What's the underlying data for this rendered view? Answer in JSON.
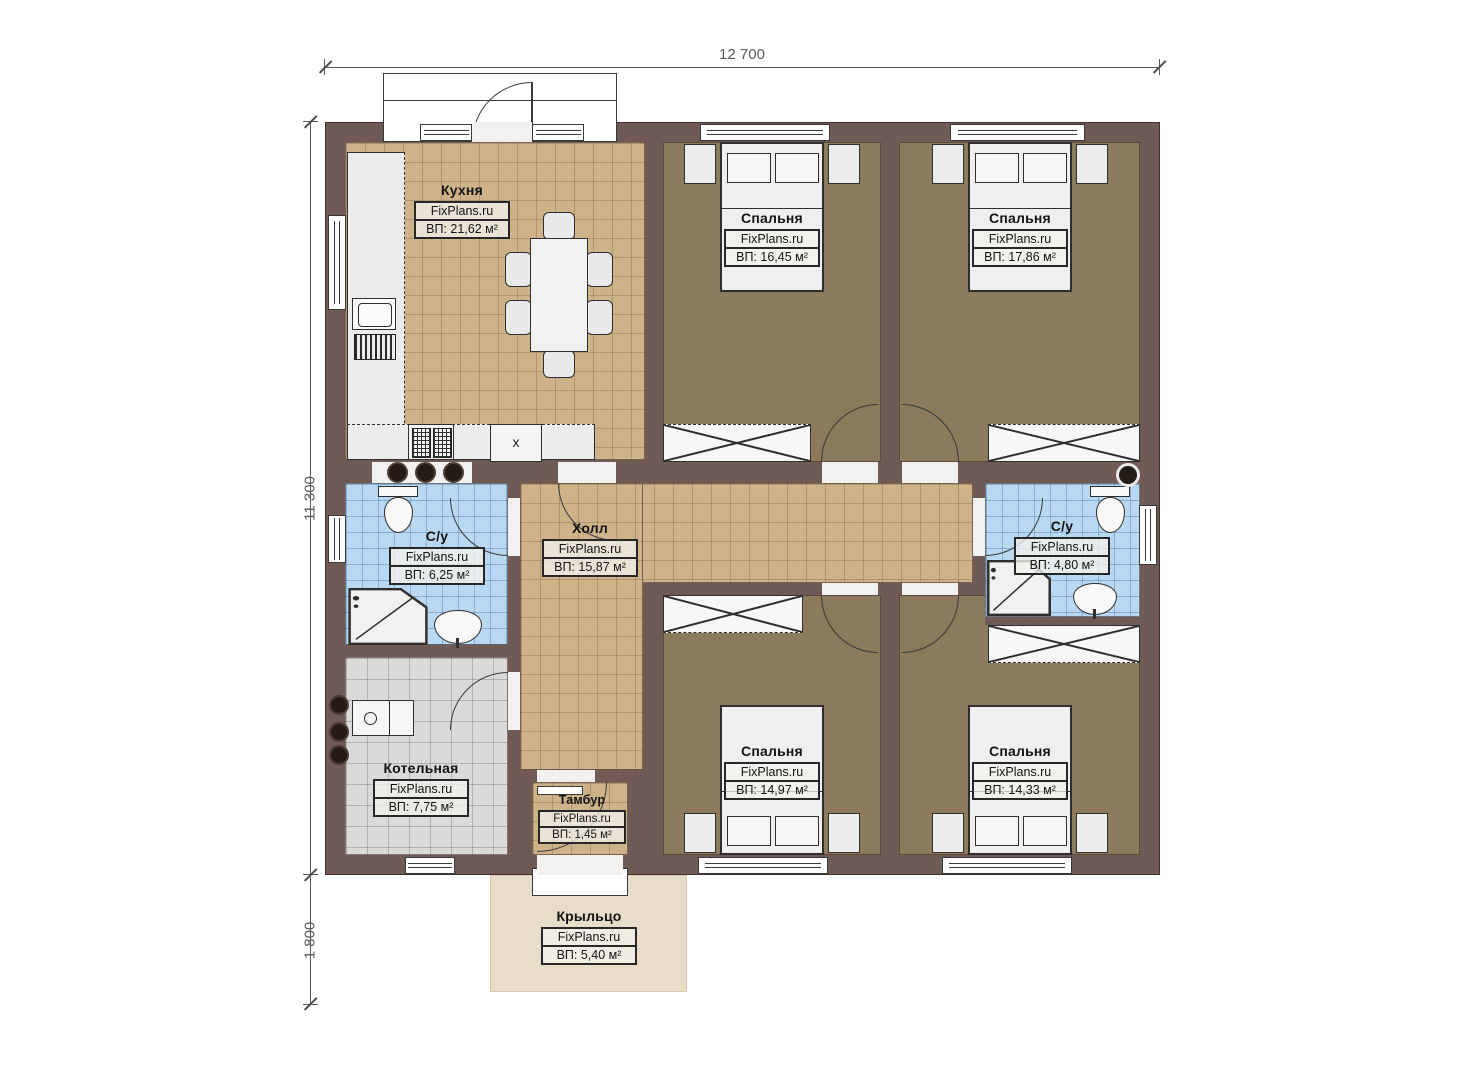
{
  "dimensions": {
    "width_top": "12 700",
    "height_left": "11 300",
    "porch_depth": "1 800"
  },
  "rooms": {
    "kitchen": {
      "name": "Кухня",
      "brand": "FixPlans.ru",
      "area": "ВП: 21,62 м²"
    },
    "bedroom_top_left": {
      "name": "Спальня",
      "brand": "FixPlans.ru",
      "area": "ВП: 16,45 м²"
    },
    "bedroom_top_right": {
      "name": "Спальня",
      "brand": "FixPlans.ru",
      "area": "ВП: 17,86 м²"
    },
    "bath_left": {
      "name": "С/у",
      "brand": "FixPlans.ru",
      "area": "ВП: 6,25 м²"
    },
    "hall": {
      "name": "Холл",
      "brand": "FixPlans.ru",
      "area": "ВП: 15,87 м²"
    },
    "bath_right": {
      "name": "С/у",
      "brand": "FixPlans.ru",
      "area": "ВП: 4,80 м²"
    },
    "boiler": {
      "name": "Котельная",
      "brand": "FixPlans.ru",
      "area": "ВП: 7,75 м²"
    },
    "vestibule": {
      "name": "Тамбур",
      "brand": "FixPlans.ru",
      "area": "ВП: 1,45 м²"
    },
    "bedroom_bottom_left": {
      "name": "Спальня",
      "brand": "FixPlans.ru",
      "area": "ВП: 14,97 м²"
    },
    "bedroom_bottom_right": {
      "name": "Спальня",
      "brand": "FixPlans.ru",
      "area": "ВП: 14,33 м²"
    },
    "porch": {
      "name": "Крыльцо",
      "brand": "FixPlans.ru",
      "area": "ВП: 5,40 м²"
    }
  },
  "appliances": {
    "fridge_mark": "x"
  },
  "colors": {
    "wall": "#6f5a55",
    "floor_tile_tan": "#cdb28a",
    "floor_bedroom": "#8b7a5c",
    "floor_bath": "#b9d8f2",
    "floor_boiler": "#dbdad8",
    "porch": "#e7ddc8"
  }
}
